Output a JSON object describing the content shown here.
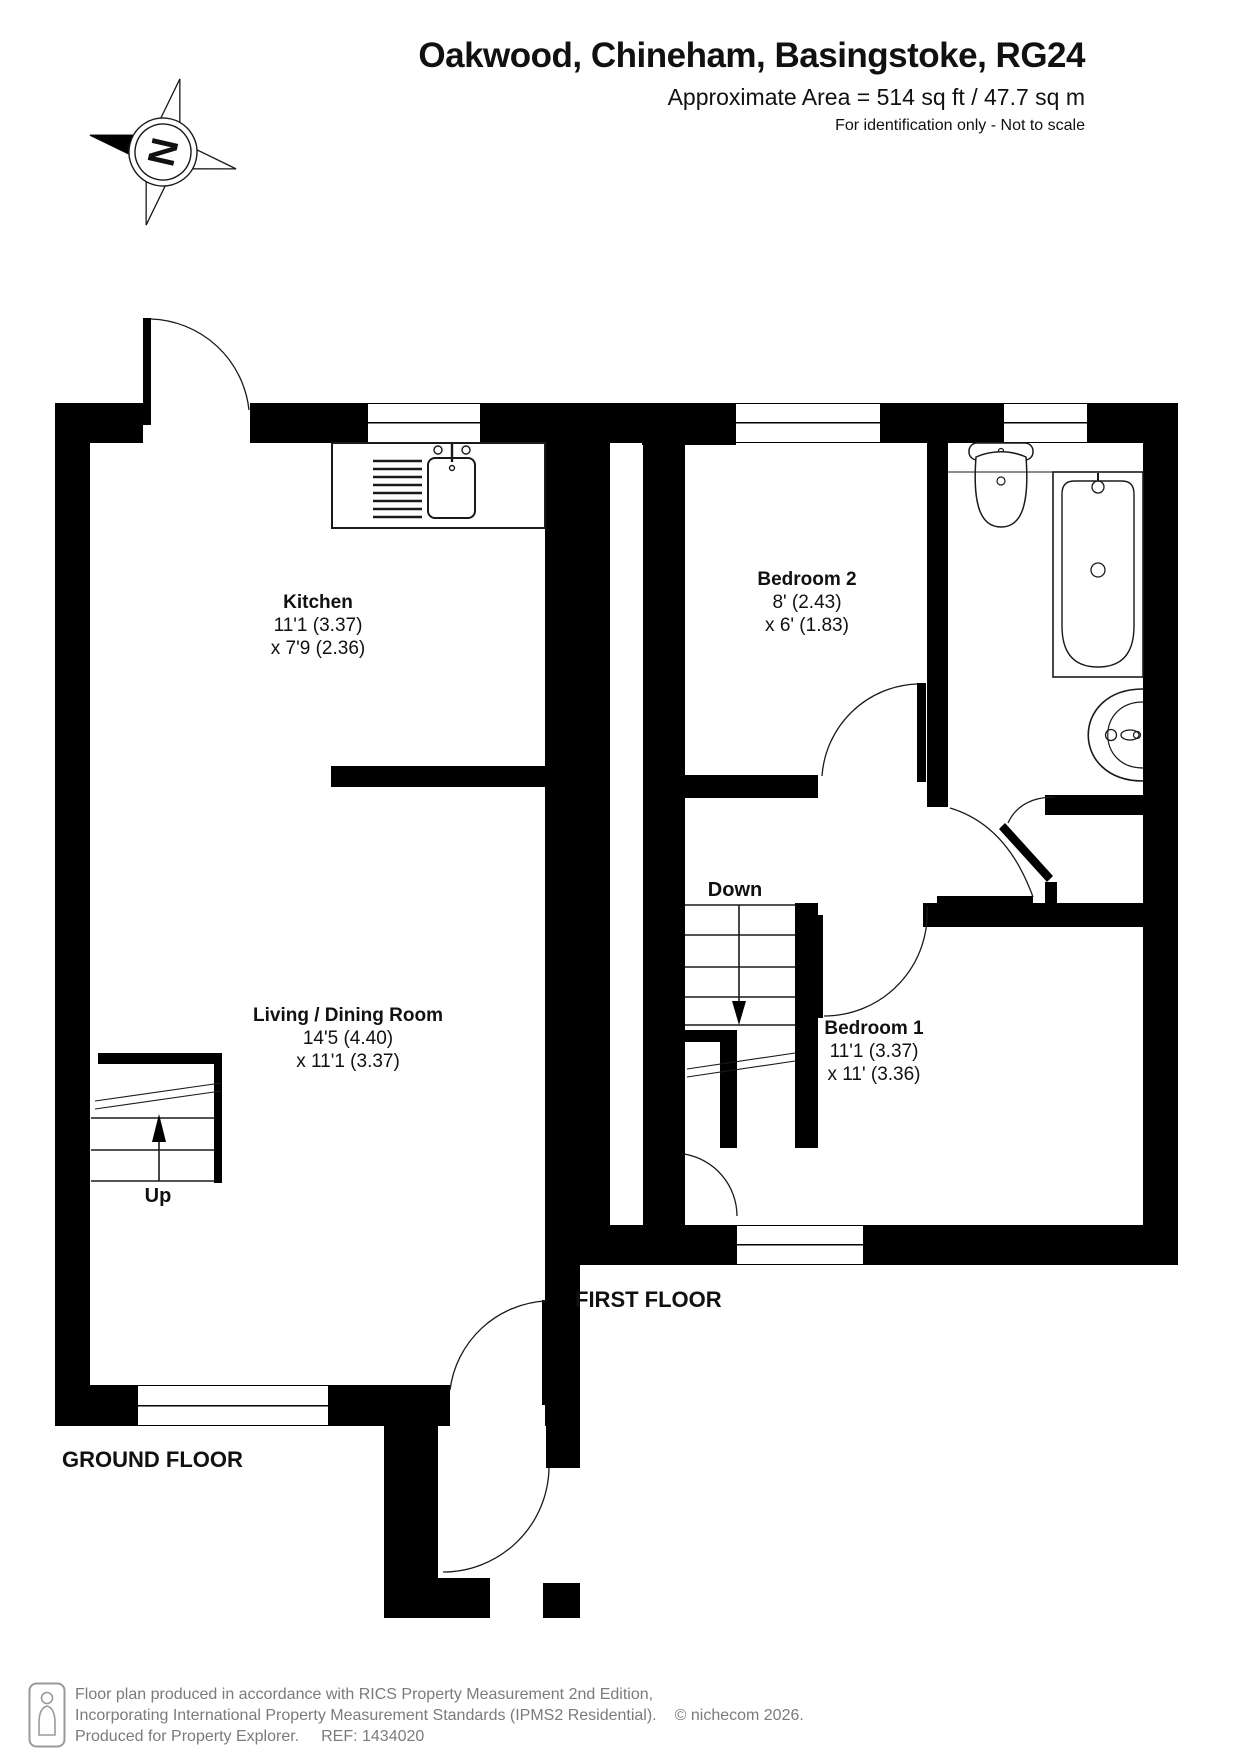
{
  "header": {
    "title": "Oakwood, Chineham, Basingstoke, RG24",
    "area_line": "Approximate Area = 514 sq ft / 47.7 sq m",
    "disclaimer": "For identification only - Not to scale",
    "compass_letter": "N"
  },
  "ground_floor": {
    "label": "GROUND FLOOR",
    "stairs_label": "Up",
    "rooms": [
      {
        "name": "Kitchen",
        "dim1": "11'1 (3.37)",
        "dim2": "x 7'9 (2.36)"
      },
      {
        "name": "Living / Dining Room",
        "dim1": "14'5 (4.40)",
        "dim2": "x 11'1 (3.37)"
      }
    ]
  },
  "first_floor": {
    "label": "FIRST FLOOR",
    "stairs_label": "Down",
    "rooms": [
      {
        "name": "Bedroom 2",
        "dim1": "8' (2.43)",
        "dim2": "x 6' (1.83)"
      },
      {
        "name": "Bedroom 1",
        "dim1": "11'1 (3.37)",
        "dim2": "x 11' (3.36)"
      }
    ]
  },
  "footer": {
    "line1": "Floor plan produced in accordance with RICS Property Measurement 2nd Edition,",
    "line2": "Incorporating International Property Measurement Standards (IPMS2 Residential).",
    "copyright": "© nichecom 2026.",
    "line3": "Produced for Property Explorer.",
    "ref": "REF: 1434020"
  },
  "icons": [
    "compass-north-icon",
    "person-scale-icon",
    "sink-icon",
    "toilet-icon",
    "bath-icon",
    "basin-icon"
  ],
  "colors": {
    "wall": "#000000",
    "line": "#1a1a1a",
    "footer_text": "#7b7b7b",
    "text": "#111111"
  }
}
